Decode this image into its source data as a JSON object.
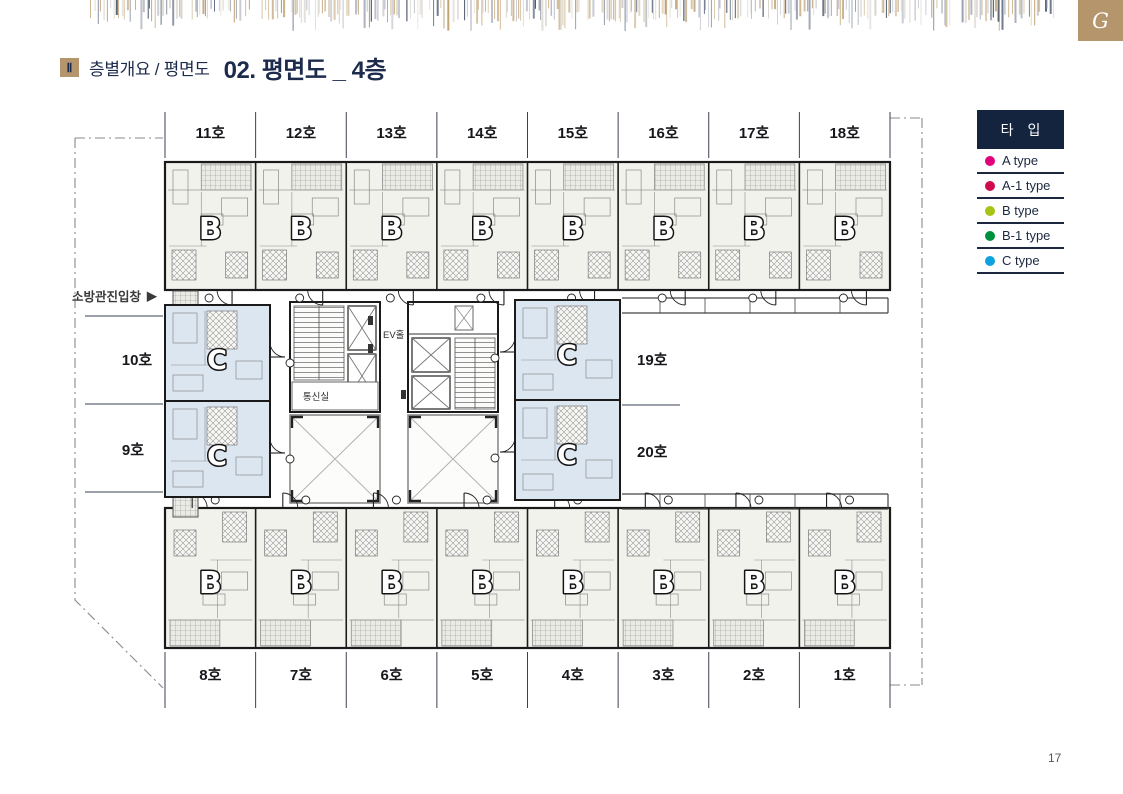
{
  "page": {
    "marker": "Ⅱ",
    "section_label": "층별개요 / 평면도",
    "title": "02. 평면도 _ 4층",
    "page_number": "17",
    "logo_monogram": "G"
  },
  "colors": {
    "navy": "#15243e",
    "gold": "#b5956b",
    "c_unit_fill": "#dce6f1",
    "b_unit_fill": "#f2f2ed"
  },
  "legend": {
    "header": "타 입",
    "items": [
      {
        "label": "A type",
        "color": "#e2007a"
      },
      {
        "label": "A-1 type",
        "color": "#cf0a4e"
      },
      {
        "label": "B type",
        "color": "#a5c416"
      },
      {
        "label": "B-1 type",
        "color": "#00913f"
      },
      {
        "label": "C type",
        "color": "#0da1e0"
      }
    ]
  },
  "plan": {
    "top_units": [
      {
        "no": "11호",
        "type": "B"
      },
      {
        "no": "12호",
        "type": "B"
      },
      {
        "no": "13호",
        "type": "B"
      },
      {
        "no": "14호",
        "type": "B"
      },
      {
        "no": "15호",
        "type": "B"
      },
      {
        "no": "16호",
        "type": "B"
      },
      {
        "no": "17호",
        "type": "B"
      },
      {
        "no": "18호",
        "type": "B"
      }
    ],
    "bottom_units": [
      {
        "no": "8호",
        "type": "B"
      },
      {
        "no": "7호",
        "type": "B"
      },
      {
        "no": "6호",
        "type": "B"
      },
      {
        "no": "5호",
        "type": "B"
      },
      {
        "no": "4호",
        "type": "B"
      },
      {
        "no": "3호",
        "type": "B"
      },
      {
        "no": "2호",
        "type": "B"
      },
      {
        "no": "1호",
        "type": "B"
      }
    ],
    "left_units": [
      {
        "no": "10호",
        "type": "C"
      },
      {
        "no": "9호",
        "type": "C"
      }
    ],
    "right_units": [
      {
        "no": "19호",
        "type": "C"
      },
      {
        "no": "20호",
        "type": "C"
      }
    ],
    "labels": {
      "fire_entry": "소방관진입창",
      "fire_entry_arrow": "▶",
      "ev_hall": "EV홀",
      "comm_room": "통신실"
    }
  }
}
